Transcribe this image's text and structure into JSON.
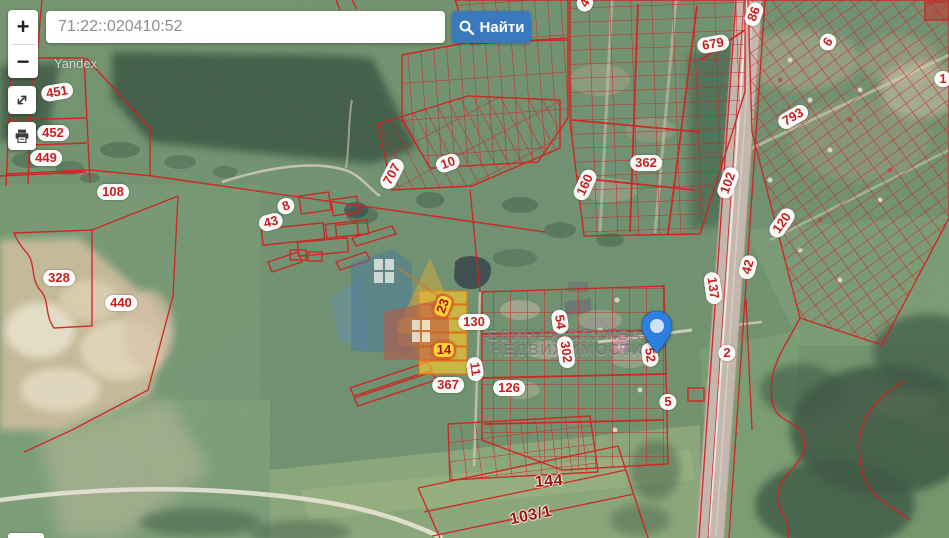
{
  "search": {
    "value": "71:22::020410:52",
    "button": "Найти"
  },
  "controls": {
    "zoom_in": "+",
    "zoom_out": "−"
  },
  "attribution": "Yandex",
  "watermark": {
    "line1": "ЕДИНАЯ СЛУЖБА",
    "line2": "НЕДВИЖИМОСТИ"
  },
  "colors": {
    "accent_blue": "#3a7abc",
    "parcel_line_red": "#d42020",
    "label_text_red": "#c91f1f",
    "highlight_gold": "#ffd23e",
    "marker_blue": "#2f80de"
  },
  "map": {
    "marker": {
      "x": 657,
      "y": 352
    },
    "labels": [
      {
        "text": "451",
        "x": 57,
        "y": 92,
        "rot": -10,
        "type": "pill"
      },
      {
        "text": "452",
        "x": 53,
        "y": 133,
        "rot": 0,
        "type": "pill"
      },
      {
        "text": "449",
        "x": 46,
        "y": 158,
        "rot": 0,
        "type": "pill"
      },
      {
        "text": "108",
        "x": 113,
        "y": 192,
        "rot": 0,
        "type": "pill"
      },
      {
        "text": "328",
        "x": 59,
        "y": 278,
        "rot": 0,
        "type": "pill"
      },
      {
        "text": "440",
        "x": 121,
        "y": 303,
        "rot": 0,
        "type": "pill"
      },
      {
        "text": "8",
        "x": 286,
        "y": 206,
        "rot": -20,
        "type": "pill"
      },
      {
        "text": "43",
        "x": 271,
        "y": 222,
        "rot": -15,
        "type": "pill"
      },
      {
        "text": "707",
        "x": 392,
        "y": 174,
        "rot": -62,
        "type": "pill"
      },
      {
        "text": "10",
        "x": 448,
        "y": 163,
        "rot": -20,
        "type": "pill"
      },
      {
        "text": "4",
        "x": 585,
        "y": 3,
        "rot": -60,
        "type": "pill"
      },
      {
        "text": "362",
        "x": 646,
        "y": 163,
        "rot": 0,
        "type": "pill"
      },
      {
        "text": "160",
        "x": 585,
        "y": 185,
        "rot": -65,
        "type": "pill"
      },
      {
        "text": "679",
        "x": 713,
        "y": 44,
        "rot": -10,
        "type": "pill"
      },
      {
        "text": "86",
        "x": 754,
        "y": 14,
        "rot": -70,
        "type": "pill"
      },
      {
        "text": "6",
        "x": 828,
        "y": 42,
        "rot": -55,
        "type": "pill"
      },
      {
        "text": "793",
        "x": 793,
        "y": 117,
        "rot": -30,
        "type": "pill"
      },
      {
        "text": "1",
        "x": 943,
        "y": 79,
        "rot": 0,
        "type": "pill"
      },
      {
        "text": "102",
        "x": 728,
        "y": 183,
        "rot": -70,
        "type": "pill"
      },
      {
        "text": "120",
        "x": 782,
        "y": 223,
        "rot": -55,
        "type": "pill"
      },
      {
        "text": "42",
        "x": 748,
        "y": 267,
        "rot": -75,
        "type": "pill"
      },
      {
        "text": "137",
        "x": 713,
        "y": 288,
        "rot": 82,
        "type": "pill"
      },
      {
        "text": "2",
        "x": 727,
        "y": 353,
        "rot": 0,
        "type": "pill"
      },
      {
        "text": "5",
        "x": 668,
        "y": 402,
        "rot": 0,
        "type": "pill"
      },
      {
        "text": "52",
        "x": 650,
        "y": 355,
        "rot": 82,
        "type": "pill"
      },
      {
        "text": "54",
        "x": 560,
        "y": 322,
        "rot": 82,
        "type": "pill"
      },
      {
        "text": "302",
        "x": 566,
        "y": 352,
        "rot": 82,
        "type": "pill"
      },
      {
        "text": "130",
        "x": 474,
        "y": 322,
        "rot": 0,
        "type": "pill"
      },
      {
        "text": "11",
        "x": 475,
        "y": 369,
        "rot": 82,
        "type": "pill"
      },
      {
        "text": "367",
        "x": 448,
        "y": 385,
        "rot": 0,
        "type": "pill"
      },
      {
        "text": "126",
        "x": 509,
        "y": 388,
        "rot": 0,
        "type": "pill"
      },
      {
        "text": "23",
        "x": 443,
        "y": 306,
        "rot": -70,
        "type": "gold"
      },
      {
        "text": "14",
        "x": 444,
        "y": 350,
        "rot": 0,
        "type": "gold"
      },
      {
        "text": "144",
        "x": 549,
        "y": 482,
        "rot": -4,
        "type": "plain"
      },
      {
        "text": "103/1",
        "x": 531,
        "y": 516,
        "rot": -12,
        "type": "plain"
      }
    ]
  }
}
